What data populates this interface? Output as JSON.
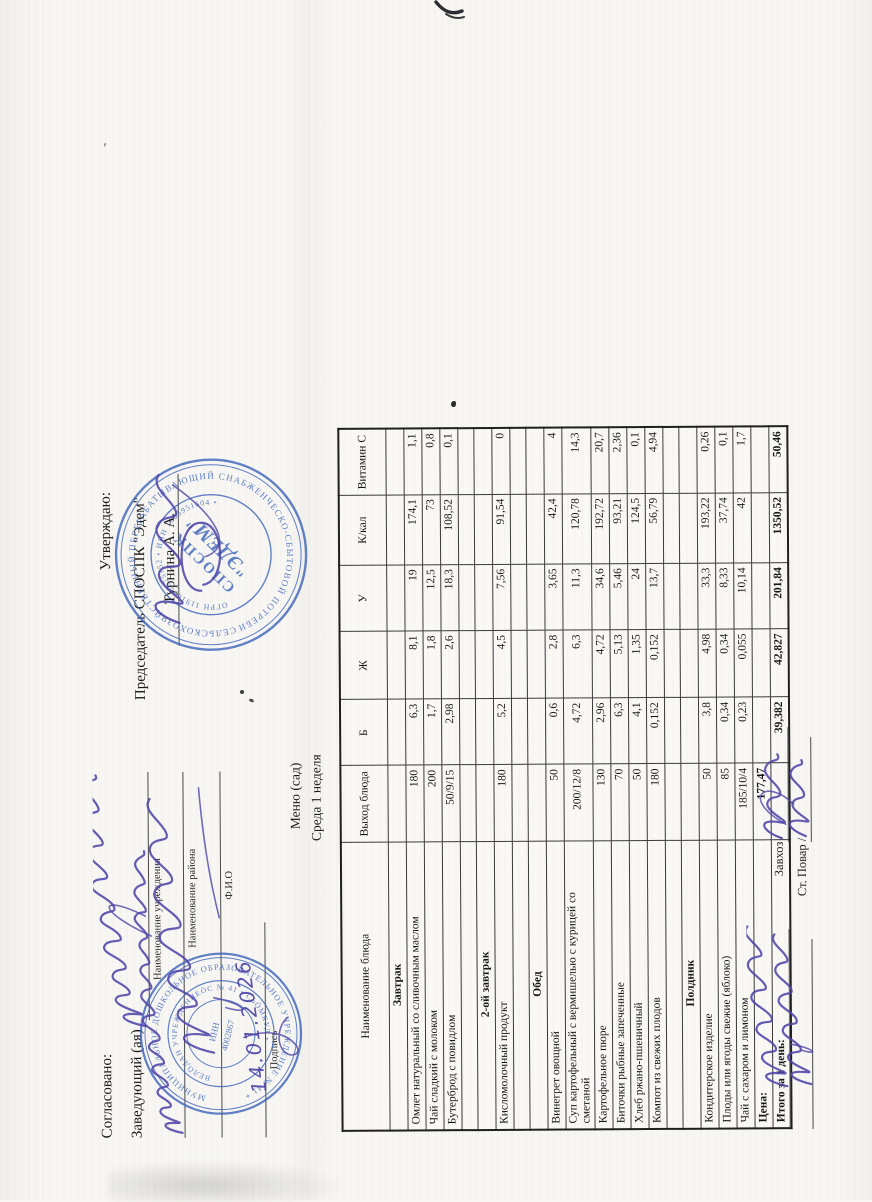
{
  "document": {
    "orientation_note": "landscape sheet scanned rotated 90 degrees counter-clockwise",
    "agreement_block": {
      "agreed_label": "Согласовано:",
      "head_label": "Заведующий (ая)",
      "institution_caption": "Наименование учреждения",
      "district_caption": "Наименование района",
      "fio_caption": "Ф.И.О",
      "signature_caption": "Подпись",
      "handwritten_date": "14.01.2026"
    },
    "approval_block": {
      "approve_label": "Утверждаю:",
      "chairman_label": "Председатель СПОСПК \"Эдем\"",
      "chairman_name": "Турнина А. А."
    },
    "title_block": {
      "menu_title": "Меню (сад)",
      "menu_subtitle": "Среда 1 неделя"
    },
    "stamps": {
      "edem": {
        "ring_outer": "СЕЛЬСКОХОЗЯЙСТВЕННЫЙ ПЕРЕРАБАТЫВАЮЩИЙ СНАБЖЕНЧЕСКО-СБЫТОВОЙ ПОТРЕБИТЕЛЬСКИЙ КООПЕРАТИВ * ",
        "ring_inner": "ОГРН 1191690075752 • ИНН 1605951604 • ",
        "center_line1": "СПОСПК",
        "center_line2": "\"ЭДЕМ\""
      },
      "dou": {
        "ring_outer": "МУНИЦИПАЛЬНОЕ ДОШКОЛЬНОЕ ОБРАЗОВАТЕЛЬНОЕ УЧРЕЖДЕНИЕ № 41 * ",
        "ring_inner": "ВЕЛÖДАН УЧРЕЖДЕНИЕÖС № 41 • СЬÖМКУД • ",
        "center_line1": "ИНН",
        "center_line2": "4002867"
      }
    },
    "table": {
      "columns": [
        "Наименование блюда",
        "Выход блюда",
        "Б",
        "Ж",
        "У",
        "К/кал",
        "Витамин С"
      ],
      "rows": [
        {
          "type": "section",
          "name": "Завтрак"
        },
        {
          "type": "item",
          "name": "Омлет натуральный со сливочным маслом",
          "out": "180",
          "b": "6,3",
          "zh": "8,1",
          "u": "19",
          "kcal": "174,1",
          "vitc": "1,1"
        },
        {
          "type": "item",
          "name": "Чай сладкий с молоком",
          "out": "200",
          "b": "1,7",
          "zh": "1,8",
          "u": "12,5",
          "kcal": "73",
          "vitc": "0,8"
        },
        {
          "type": "item",
          "name": "Бутерброд с повидлом",
          "out": "50/9/15",
          "b": "2,98",
          "zh": "2,6",
          "u": "18,3",
          "kcal": "108,52",
          "vitc": "0,1"
        },
        {
          "type": "blank"
        },
        {
          "type": "section",
          "name": "2-ой завтрак"
        },
        {
          "type": "item",
          "name": "Кисломолочный продукт",
          "out": "180",
          "b": "5,2",
          "zh": "4,5",
          "u": "7,56",
          "kcal": "91,54",
          "vitc": "0"
        },
        {
          "type": "blank"
        },
        {
          "type": "section",
          "name": "Обед"
        },
        {
          "type": "item",
          "name": "Винегрет овощной",
          "out": "50",
          "b": "0,6",
          "zh": "2,8",
          "u": "3,65",
          "kcal": "42,4",
          "vitc": "4"
        },
        {
          "type": "item",
          "name": "Суп картофельный с вермишелью с курицей со сметаной",
          "out": "200/12/8",
          "b": "4,72",
          "zh": "6,3",
          "u": "11,3",
          "kcal": "120,78",
          "vitc": "14,3"
        },
        {
          "type": "item",
          "name": "Картофельное пюре",
          "out": "130",
          "b": "2,96",
          "zh": "4,72",
          "u": "34,6",
          "kcal": "192,72",
          "vitc": "20,7"
        },
        {
          "type": "item",
          "name": "Биточки рыбные запеченные",
          "out": "70",
          "b": "6,3",
          "zh": "5,13",
          "u": "5,46",
          "kcal": "93,21",
          "vitc": "2,36"
        },
        {
          "type": "item",
          "name": "Хлеб ржано-пшеничный",
          "out": "50",
          "b": "4,1",
          "zh": "1,35",
          "u": "24",
          "kcal": "124,5",
          "vitc": "0,1"
        },
        {
          "type": "item",
          "name": "Компот из свежих плодов",
          "out": "180",
          "b": "0,152",
          "zh": "0,152",
          "u": "13,7",
          "kcal": "56,79",
          "vitc": "4,94"
        },
        {
          "type": "blank"
        },
        {
          "type": "section",
          "name": "Полдник"
        },
        {
          "type": "item",
          "name": "Кондитерское изделие",
          "out": "50",
          "b": "3,8",
          "zh": "4,98",
          "u": "33,3",
          "kcal": "193,22",
          "vitc": "0,26"
        },
        {
          "type": "item",
          "name": "Плоды или ягоды свежие (яблоко)",
          "out": "85",
          "b": "0,34",
          "zh": "0,34",
          "u": "8,33",
          "kcal": "37,74",
          "vitc": "0,1"
        },
        {
          "type": "item",
          "name": "Чай с сахаром и лимоном",
          "out": "185/10/4",
          "b": "0,23",
          "zh": "0,055",
          "u": "10,14",
          "kcal": "42",
          "vitc": "1,7"
        },
        {
          "type": "price",
          "name": "Цена:",
          "out": "177,47"
        },
        {
          "type": "total",
          "name": "Итого за 1 день:",
          "b": "39,382",
          "zh": "42,827",
          "u": "201,84",
          "kcal": "1350,52",
          "vitc": "50,46"
        }
      ]
    },
    "footer": {
      "zavhoz_label": "Завхоз /",
      "cook_label": "Ст. Повар /"
    }
  },
  "colors": {
    "paper": "#f7f6f2",
    "ink": "#1b1b1b",
    "pen_purple": "#4c42a6",
    "stamp_blue": "#3f66bd"
  }
}
